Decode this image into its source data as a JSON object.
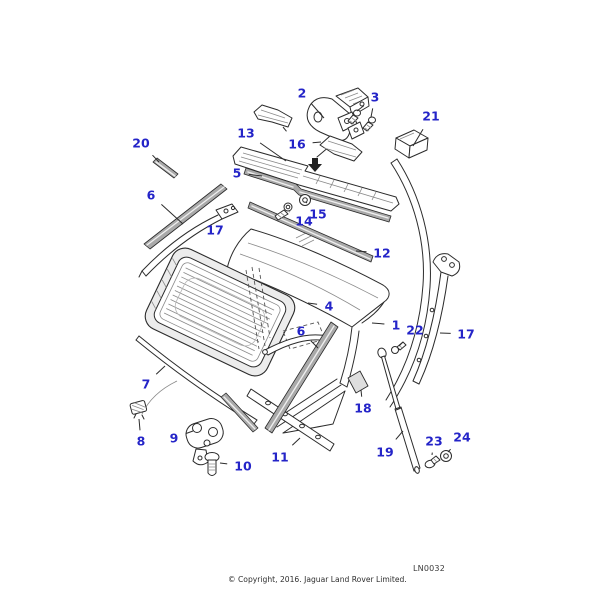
{
  "diagram": {
    "drawing_code": "LN0032",
    "copyright_line": "© Copyright, 2016. Jaguar Land Rover Limited.",
    "callout_color": "#2424c8",
    "leader_color": "#2b2b2b",
    "callouts": [
      {
        "label": "2",
        "x": 302,
        "y": 93,
        "leaders": [
          [
            324,
            118
          ]
        ]
      },
      {
        "label": "3",
        "x": 375,
        "y": 97,
        "leaders": [
          [
            357,
            111
          ],
          [
            371,
            117
          ]
        ]
      },
      {
        "label": "21",
        "x": 431,
        "y": 116,
        "leaders": [
          [
            413,
            146
          ]
        ]
      },
      {
        "label": "13",
        "x": 246,
        "y": 133,
        "leaders": [
          [
            286,
            161
          ]
        ]
      },
      {
        "label": "20",
        "x": 141,
        "y": 143,
        "leaders": [
          [
            159,
            162
          ]
        ]
      },
      {
        "label": "16",
        "x": 297,
        "y": 144,
        "leaders": [
          [
            283,
            127
          ],
          [
            321,
            142
          ]
        ]
      },
      {
        "label": "5",
        "x": 237,
        "y": 173,
        "leaders": [
          [
            262,
            176
          ]
        ]
      },
      {
        "label": "6",
        "x": 151,
        "y": 195,
        "leaders": [
          [
            183,
            224
          ]
        ]
      },
      {
        "label": "17",
        "x": 215,
        "y": 230,
        "leaders": [
          [
            199,
            233
          ]
        ]
      },
      {
        "label": "15",
        "x": 318,
        "y": 214,
        "leaders": [
          [
            307,
            203
          ]
        ]
      },
      {
        "label": "14",
        "x": 304,
        "y": 221,
        "leaders": [
          [
            290,
            212
          ]
        ]
      },
      {
        "label": "12",
        "x": 382,
        "y": 253,
        "leaders": [
          [
            356,
            251
          ]
        ]
      },
      {
        "label": "4",
        "x": 329,
        "y": 306,
        "leaders": [
          [
            308,
            303
          ]
        ]
      },
      {
        "label": "1",
        "x": 396,
        "y": 325,
        "leaders": [
          [
            372,
            323
          ]
        ]
      },
      {
        "label": "22",
        "x": 415,
        "y": 330,
        "leaders": [
          [
            399,
            346
          ]
        ]
      },
      {
        "label": "6",
        "x": 301,
        "y": 331,
        "leaders": [
          [
            318,
            348
          ]
        ]
      },
      {
        "label": "17",
        "x": 466,
        "y": 334,
        "leaders": [
          [
            440,
            333
          ]
        ]
      },
      {
        "label": "18",
        "x": 363,
        "y": 408,
        "leaders": [
          [
            361,
            390
          ]
        ]
      },
      {
        "label": "7",
        "x": 146,
        "y": 384,
        "leaders": [
          [
            165,
            366
          ]
        ]
      },
      {
        "label": "8",
        "x": 141,
        "y": 441,
        "leaders": [
          [
            139,
            419
          ]
        ]
      },
      {
        "label": "9",
        "x": 174,
        "y": 438,
        "leaders": [
          [
            193,
            431
          ]
        ]
      },
      {
        "label": "10",
        "x": 243,
        "y": 466,
        "leaders": [
          [
            220,
            463
          ]
        ]
      },
      {
        "label": "11",
        "x": 280,
        "y": 457,
        "leaders": [
          [
            300,
            438
          ]
        ]
      },
      {
        "label": "19",
        "x": 385,
        "y": 452,
        "leaders": [
          [
            403,
            431
          ]
        ]
      },
      {
        "label": "23",
        "x": 434,
        "y": 441,
        "leaders": [
          [
            432,
            455
          ]
        ]
      },
      {
        "label": "24",
        "x": 462,
        "y": 437,
        "leaders": [
          [
            448,
            452
          ]
        ]
      }
    ]
  }
}
